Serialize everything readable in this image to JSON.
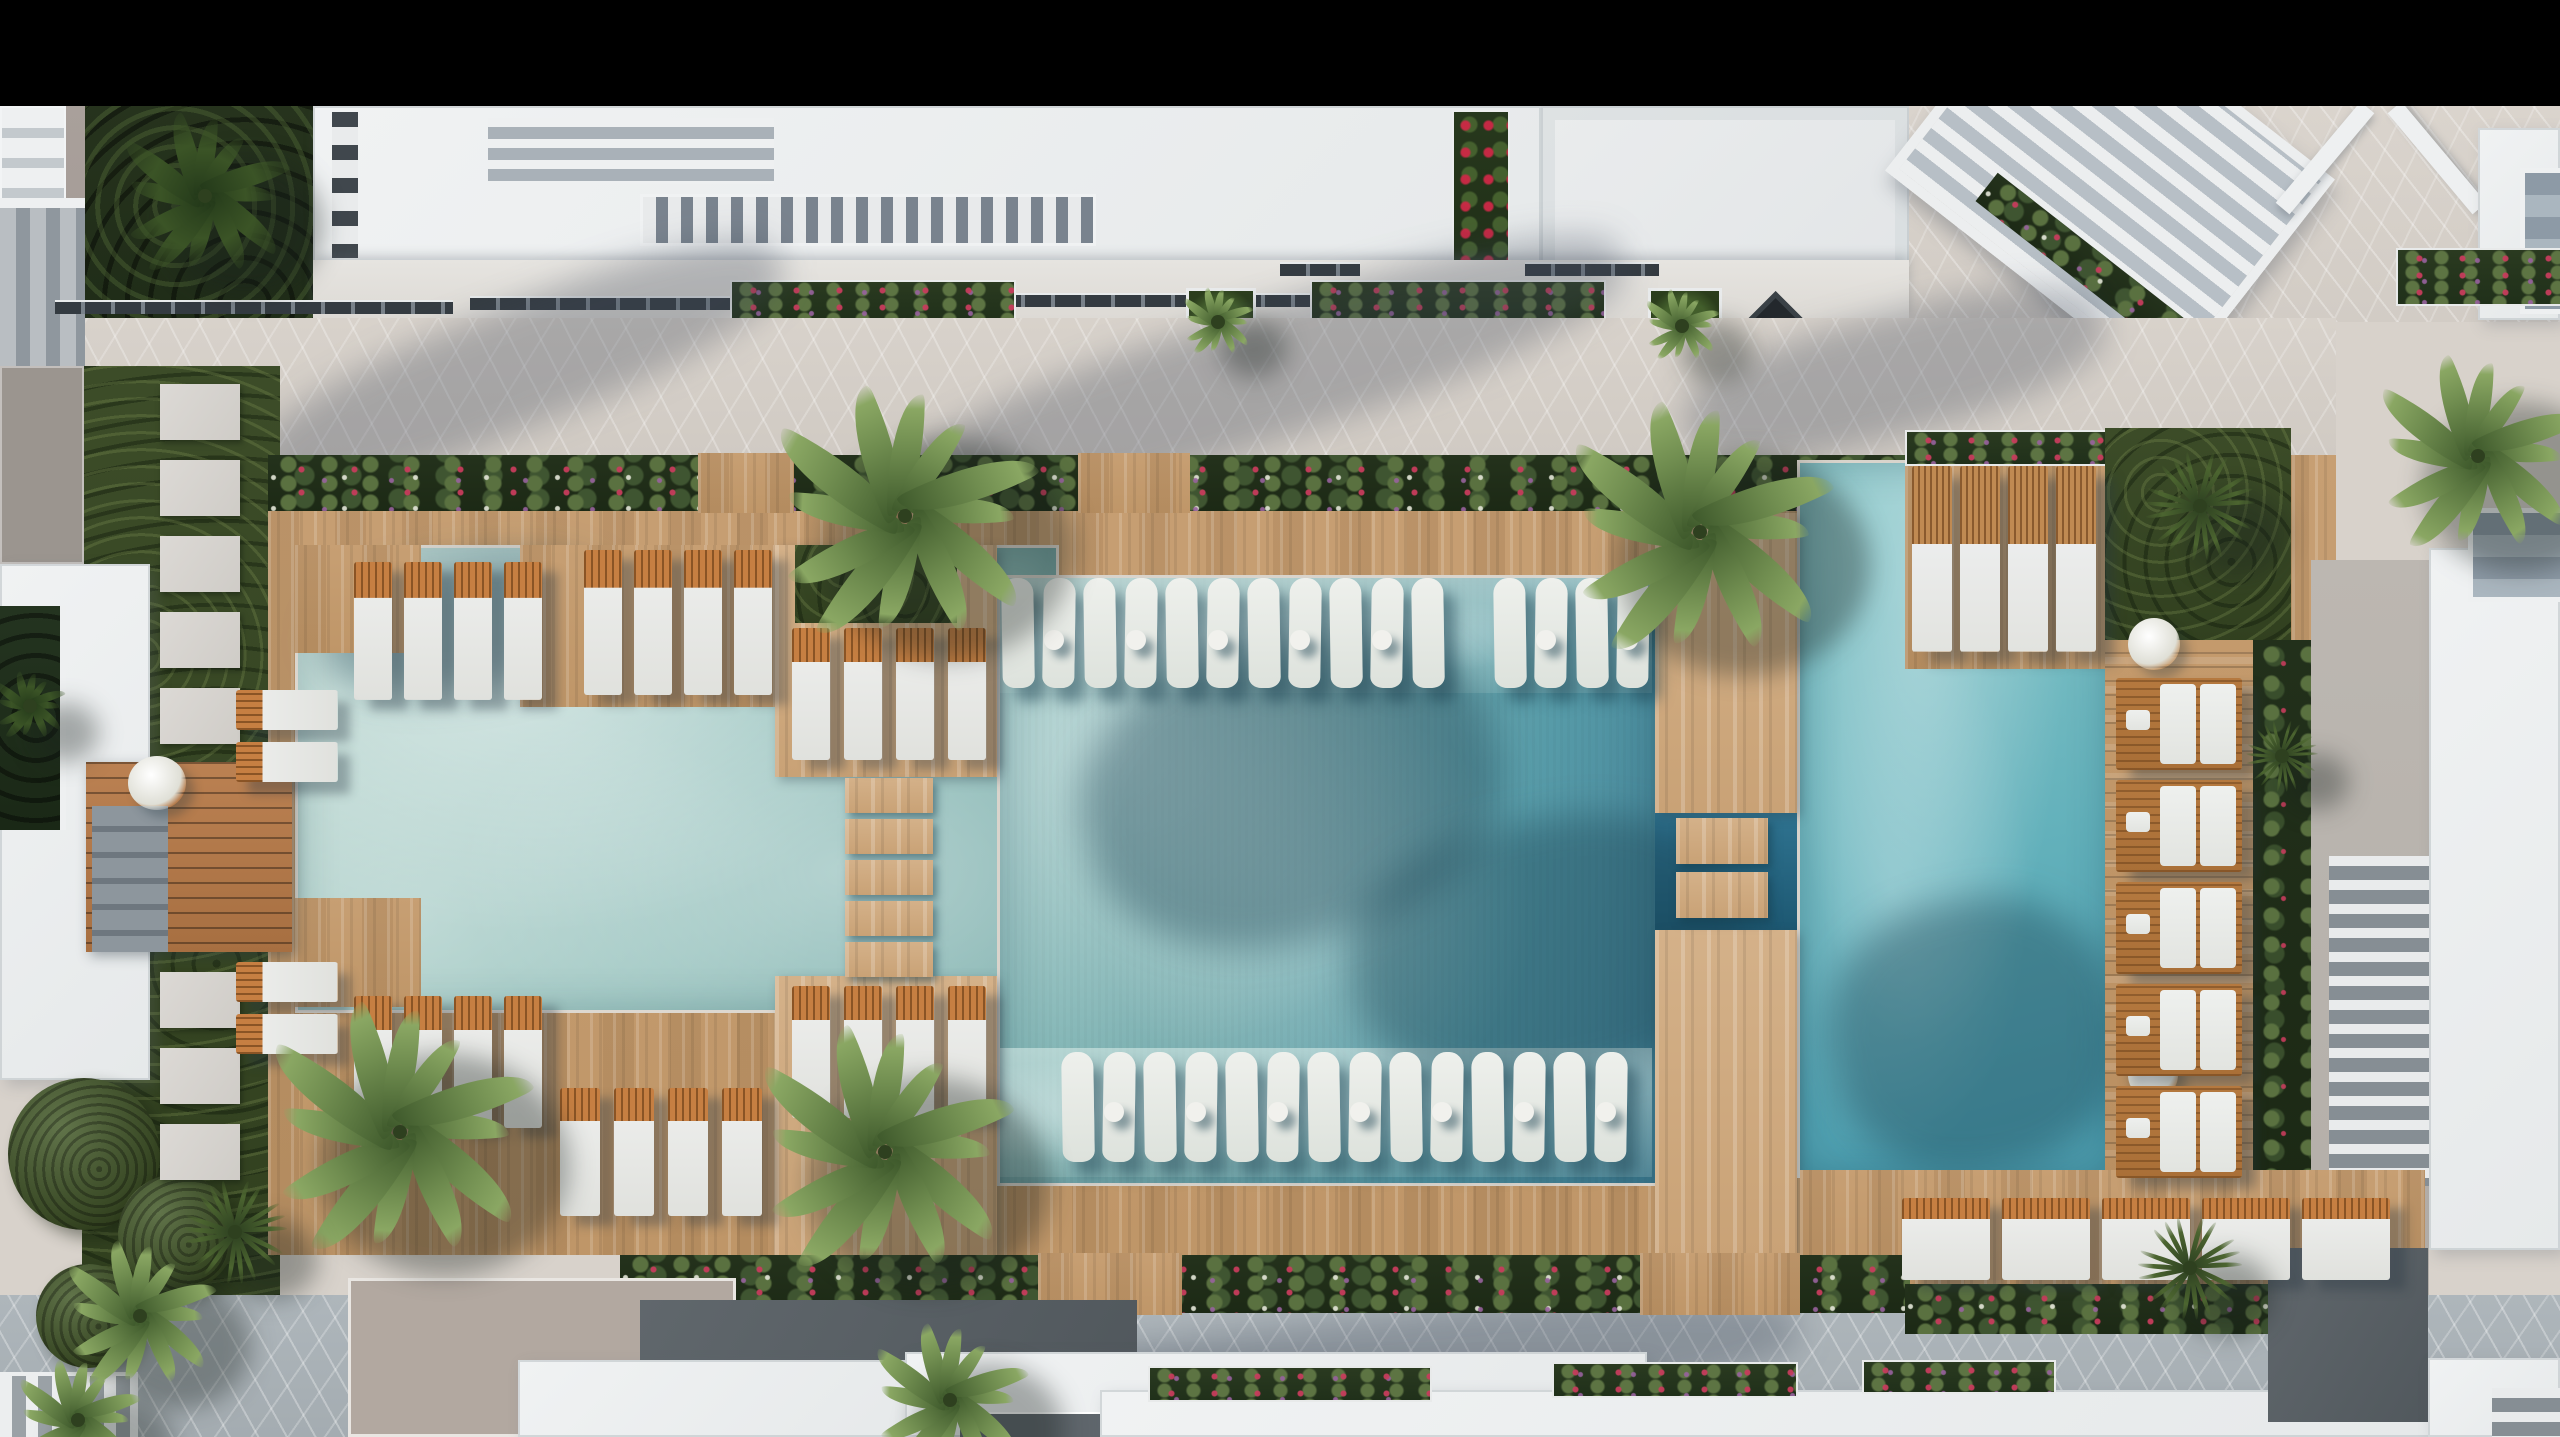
{
  "scene": {
    "type": "aerial-architectural-render",
    "subject": "Top-down aerial render of a resort condominium pool courtyard with wooden sun deck, three connected pool sections, in-pool loungers, palm trees, gardens and surrounding white apartment buildings",
    "view": "top-down",
    "letterbox_top": true
  },
  "palette": {
    "letterbox": "#000000",
    "plaza": "#d8d2cb",
    "promenade": "#aeb6bb",
    "building_white": "#edeff0",
    "roof_taupe": "#b2a8a0",
    "roof_dark": "#565c60",
    "deck": "#c79f73",
    "deck_light": "#d4b189",
    "bridge": "#bb8152",
    "grass": "#3c4c28",
    "foliage": "#26331d",
    "planting": "#24321c",
    "palm": "#6f8c4f",
    "pool_left": "#b6d4cd",
    "pool_center": "#79aeb0",
    "pool_right": "#63b1bb",
    "pool_deep": "#1d5872",
    "inpool": "#eef0ec",
    "lounger_cushion": "#ebecea",
    "lounger_frame": "#c67f42",
    "lounger_wood": "#b5793f",
    "flower_red": "#c23a55",
    "flower_purple": "#96619c"
  },
  "inventory": {
    "pool_sections": 3,
    "deck_lounger_groups": 10,
    "deck_loungers": 37,
    "in_pool_loungers": 29,
    "in_pool_side_tables": 14,
    "wood_slat_double_loungers": 5,
    "parasols": 2,
    "palm_trees": 16,
    "stepping_stones": 8,
    "topiary_balls": 3,
    "flower_planters": 9,
    "deck_step_pads": 7
  }
}
